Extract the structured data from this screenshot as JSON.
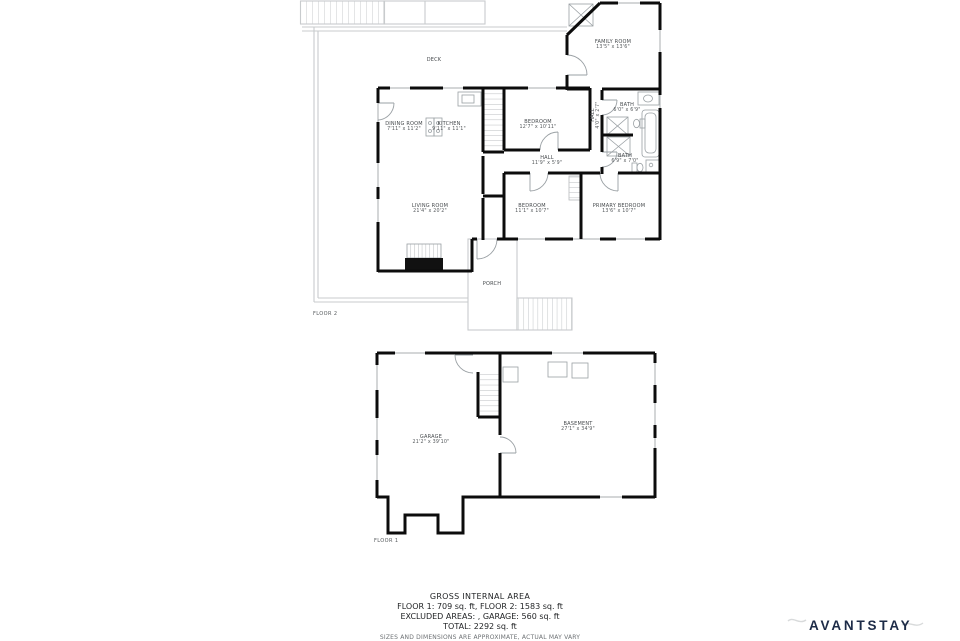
{
  "floor2": {
    "label": "FLOOR 2",
    "rooms": [
      {
        "name": "DECK",
        "dims": ""
      },
      {
        "name": "FAMILY ROOM",
        "dims": "13'5\" x 13'6\""
      },
      {
        "name": "DINING ROOM",
        "dims": "7'11\" x 11'2\""
      },
      {
        "name": "KITCHEN",
        "dims": "9'11\" x 11'1\""
      },
      {
        "name": "BEDROOM",
        "dims": "12'7\" x 10'11\""
      },
      {
        "name": "BATH",
        "dims": "6'0\" x 6'9\""
      },
      {
        "name": "HALL",
        "dims": "4'0\" x 2'7\""
      },
      {
        "name": "HALL",
        "dims": "11'9\" x 5'9\""
      },
      {
        "name": "BATH",
        "dims": "6'9\" x 7'0\""
      },
      {
        "name": "LIVING ROOM",
        "dims": "21'4\" x 20'2\""
      },
      {
        "name": "BEDROOM",
        "dims": "11'1\" x 10'7\""
      },
      {
        "name": "PRIMARY BEDROOM",
        "dims": "13'6\" x 10'7\""
      },
      {
        "name": "PORCH",
        "dims": ""
      }
    ]
  },
  "floor1": {
    "label": "FLOOR 1",
    "rooms": [
      {
        "name": "GARAGE",
        "dims": "21'2\" x 39'10\""
      },
      {
        "name": "BASEMENT",
        "dims": "27'1\" x 34'9\""
      }
    ]
  },
  "summary": {
    "title": "GROSS INTERNAL AREA",
    "line1": "FLOOR 1: 709 sq. ft, FLOOR 2: 1583 sq. ft",
    "line2": "EXCLUDED AREAS: , GARAGE: 560 sq. ft",
    "line3": "TOTAL: 2292 sq. ft",
    "disclaimer": "SIZES AND DIMENSIONS ARE APPROXIMATE, ACTUAL MAY VARY"
  },
  "branding": {
    "logo": "AVANTSTAY",
    "logo_color": "#1d2b47"
  },
  "colors": {
    "wall": "#0c0c0c",
    "thin_fixture": "#9aa0a4",
    "deck_line": "#c8cbcd",
    "label_text": "#45494c"
  }
}
